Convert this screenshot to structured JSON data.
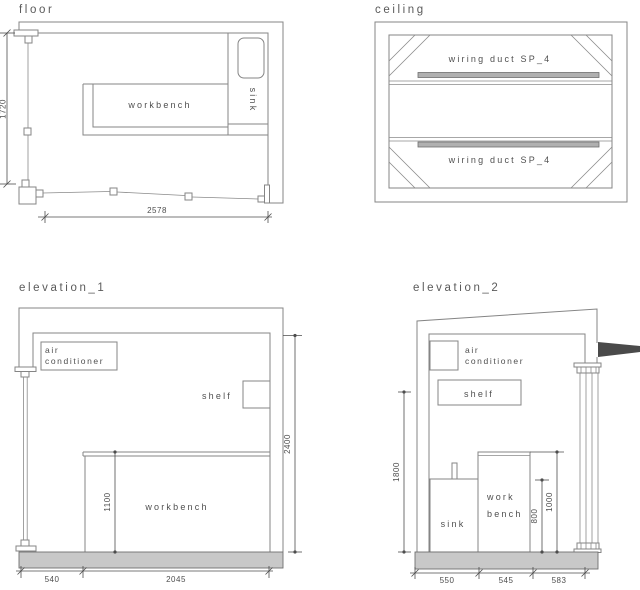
{
  "floor": {
    "title": "floor",
    "workbench_label": "workbench",
    "sink_label": "sink",
    "dim_height": "1720",
    "dim_width": "2578"
  },
  "ceiling": {
    "title": "ceiling",
    "duct_top_label": "wiring duct SP_4",
    "duct_bottom_label": "wiring duct SP_4"
  },
  "elevation_1": {
    "title": "elevation_1",
    "ac_label_line1": "air",
    "ac_label_line2": "conditioner",
    "shelf_label": "shelf",
    "workbench_label": "workbench",
    "dim_ceiling_height": "2400",
    "dim_workbench_height": "1100",
    "dim_bottom_left": "540",
    "dim_bottom_right": "2045"
  },
  "elevation_2": {
    "title": "elevation_2",
    "ac_label_line1": "air",
    "ac_label_line2": "conditioner",
    "shelf_label": "shelf",
    "sink_label": "sink",
    "workbench_label_line1": "work",
    "workbench_label_line2": "bench",
    "dim_wall_height": "1800",
    "dim_sink_height": "800",
    "dim_workbench_height": "1000",
    "dim_bottom_1": "550",
    "dim_bottom_2": "545",
    "dim_bottom_3": "583"
  },
  "colors": {
    "line": "#858585",
    "dimension": "#4d4d4d",
    "text": "#4f4f4f",
    "slab_fill": "#c8c8c8",
    "duct_fill": "#b0b0b0",
    "roof_wedge": "#4a4a4a"
  }
}
